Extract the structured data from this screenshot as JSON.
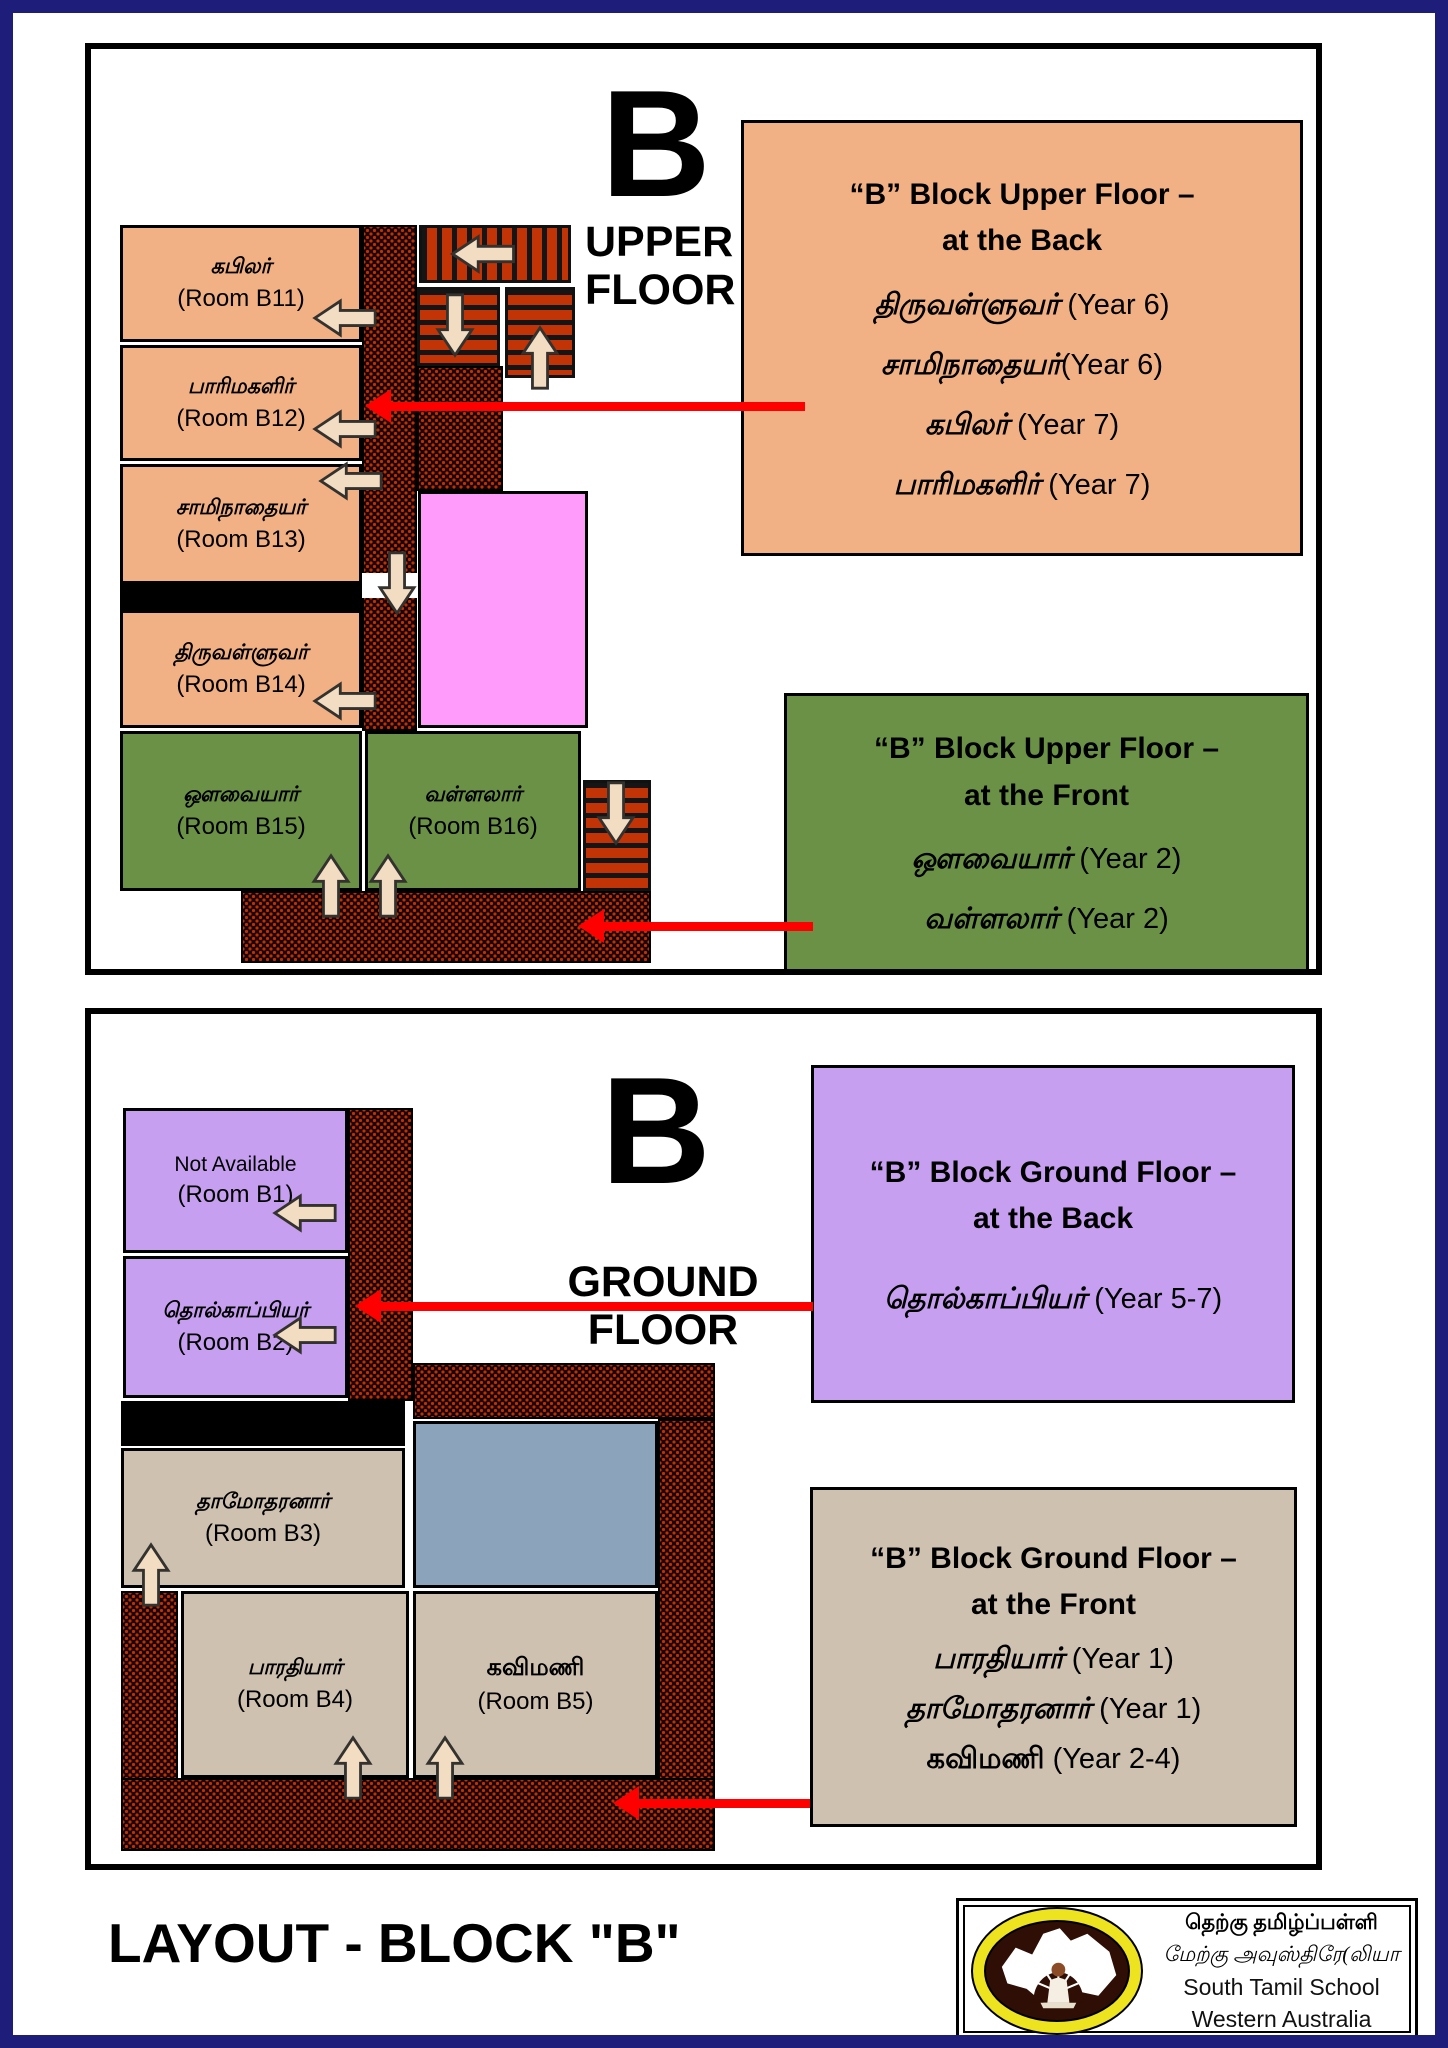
{
  "upper": {
    "big_letter": "B",
    "floor_line1": "UPPER",
    "floor_line2": "FLOOR",
    "rooms": {
      "b11": {
        "name": "கபிலர்",
        "room": "(Room B11)"
      },
      "b12": {
        "name": "பாரிமகளிர்",
        "room": "(Room B12)"
      },
      "b13": {
        "name": "சாமிநாதையர்",
        "room": "(Room B13)"
      },
      "b14": {
        "name": "திருவள்ளுவர்",
        "room": "(Room B14)"
      },
      "b15": {
        "name": "ஔவையார்",
        "room": "(Room B15)"
      },
      "b16": {
        "name": "வள்ளலார்",
        "room": "(Room B16)"
      }
    },
    "legend_back": {
      "title_line1": "“B” Block Upper Floor –",
      "title_line2": "at the Back",
      "entries": [
        {
          "name": "திருவள்ளுவர்",
          "year": "(Year 6)"
        },
        {
          "name": "சாமிநாதையர்",
          "year": "(Year 6)"
        },
        {
          "name": "கபிலர்",
          "year": "(Year  7)"
        },
        {
          "name": "பாரிமகளிர்",
          "year": "(Year 7)"
        }
      ]
    },
    "legend_front": {
      "title_line1": "“B” Block Upper Floor –",
      "title_line2": "at the Front",
      "entries": [
        {
          "name": "ஔவையார்",
          "year": "(Year 2)"
        },
        {
          "name": "வள்ளலார்",
          "year": "(Year 2)"
        }
      ]
    }
  },
  "ground": {
    "big_letter": "B",
    "floor_line1": "GROUND",
    "floor_line2": "FLOOR",
    "rooms": {
      "b1": {
        "name": "Not Available",
        "room": "(Room B1)"
      },
      "b2": {
        "name": "தொல்காப்பியர்",
        "room": "(Room B2)"
      },
      "b3": {
        "name": "தாமோதரனார்",
        "room": "(Room B3)"
      },
      "b4": {
        "name": "பாரதியார்",
        "room": "(Room B4)"
      },
      "b5": {
        "name": "கவிமணி",
        "room": "(Room B5)"
      }
    },
    "legend_back": {
      "title_line1": "“B” Block Ground Floor –",
      "title_line2": "at the Back",
      "entries": [
        {
          "name": "தொல்காப்பியர்",
          "year": "(Year 5-7)"
        }
      ]
    },
    "legend_front": {
      "title_line1": "“B” Block Ground Floor –",
      "title_line2": "at the Front",
      "entries": [
        {
          "name": "பாரதியார்",
          "year": "(Year 1)"
        },
        {
          "name": "தாமோதரனார்",
          "year": "(Year 1)"
        },
        {
          "name": "கவிமணி",
          "year": "(Year 2-4)"
        }
      ]
    }
  },
  "footer": {
    "title": "LAYOUT - BLOCK \"B\"",
    "org_line1": "தெற்கு தமிழ்ப்பள்ளி",
    "org_line2": "மேற்கு அவுஸ்திரே(லியா",
    "org_line3": "South Tamil School",
    "org_line4": "Western Australia"
  },
  "colors": {
    "page_border_navy": "#1E1E7A",
    "peach": "#F2B184",
    "green": "#6A9145",
    "purple": "#C79FF0",
    "tan": "#CEC1B0",
    "pink": "#FF9BFB",
    "blue_gray": "#8CA3BC",
    "stair_orange": "#C23305",
    "corridor_brick": "#C23000",
    "arrow_cream": "#F2DCC2",
    "arrow_red": "#FF0000"
  }
}
